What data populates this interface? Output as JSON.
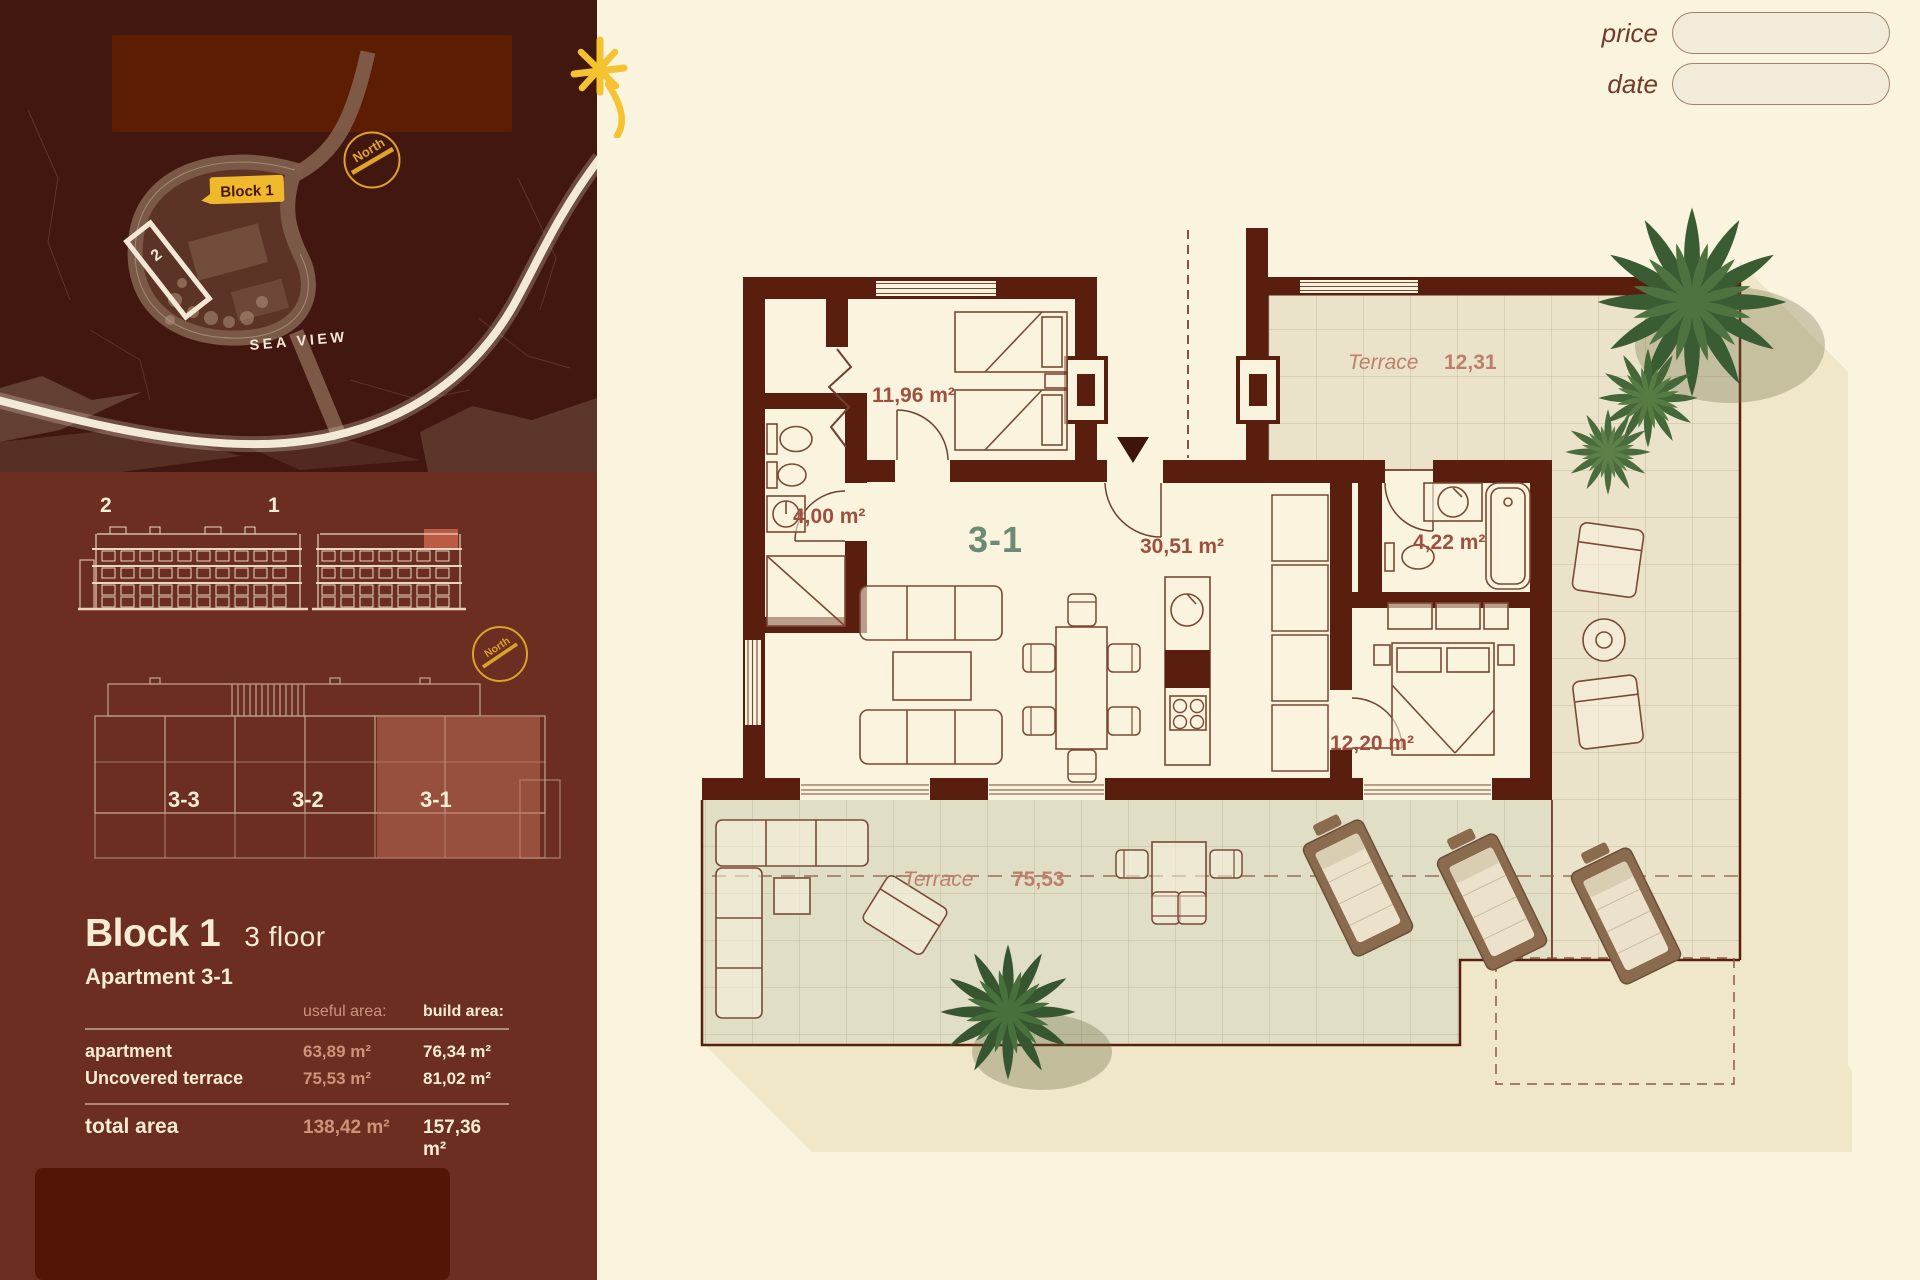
{
  "header": {
    "price_label": "price",
    "date_label": "date"
  },
  "sidebar": {
    "site_map": {
      "block_badge": "Block 1",
      "building_number": "2",
      "north_label": "North",
      "road_label": "SEA VIEW"
    },
    "elevations": {
      "building_left_label": "2",
      "building_right_label": "1",
      "north_label": "North"
    },
    "floor_overview": {
      "units": [
        "3-3",
        "3-2",
        "3-1"
      ]
    },
    "info": {
      "block_title": "Block 1",
      "floor_label": "3 floor",
      "apartment_label": "Apartment 3-1",
      "table": {
        "useful_header": "useful area:",
        "build_header": "build area:",
        "rows": [
          {
            "name": "apartment",
            "useful": "63,89 m²",
            "build": "76,34 m²"
          },
          {
            "name": "Uncovered terrace",
            "useful": "75,53 m²",
            "build": "81,02 m²"
          }
        ],
        "total": {
          "name": "total area",
          "useful": "138,42 m²",
          "build": "157,36 m²"
        }
      }
    }
  },
  "floor_plan": {
    "unit_label": "3-1",
    "rooms": {
      "bedroom1": "11,96 m²",
      "bathroom1": "4,00 m²",
      "living": "30,51 m²",
      "bathroom2": "4,22 m²",
      "bedroom2": "12,20 m²"
    },
    "terrace_top": {
      "name": "Terrace",
      "area": "12,31"
    },
    "terrace_bottom": {
      "name": "Terrace",
      "area": "75,53"
    }
  },
  "theme": {
    "accent_yellow": "#f0b92b",
    "wall_color": "#5a1e0f",
    "sidebar_color": "#6b2e20",
    "map_bg": "#41170f",
    "cream": "#faf3de",
    "salmon": "#cf8f76",
    "unit_green": "#6d8a74",
    "highlight_salmon": "#c4725a"
  }
}
